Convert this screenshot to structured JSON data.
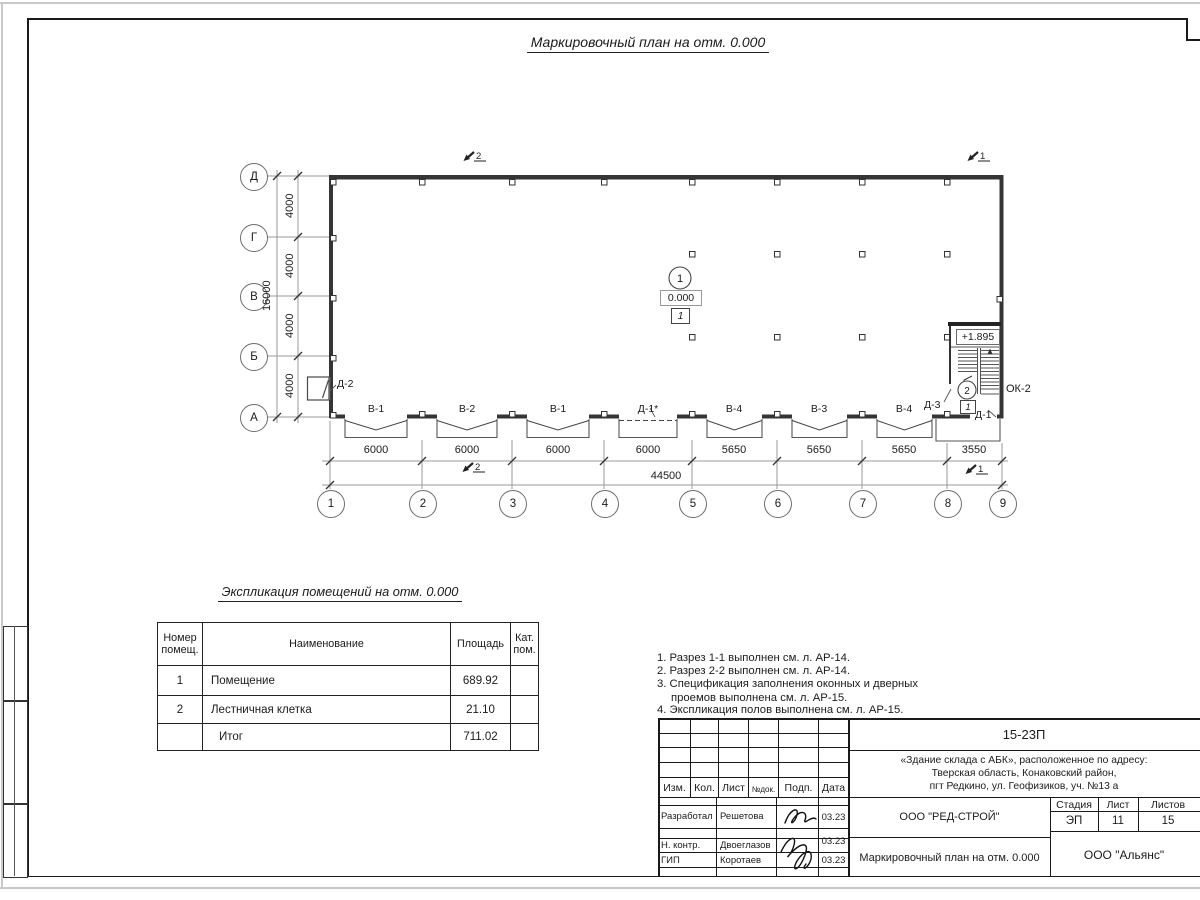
{
  "page": {
    "title": "Маркировочный план на отм. 0.000"
  },
  "plan": {
    "sec1": "1",
    "sec2": "2",
    "row_axes": [
      "Д",
      "Г",
      "В",
      "Б",
      "А"
    ],
    "col_axes": [
      "1",
      "2",
      "3",
      "4",
      "5",
      "6",
      "7",
      "8",
      "9"
    ],
    "v_dims": [
      "4000",
      "4000",
      "4000",
      "4000"
    ],
    "v_total": "16000",
    "h_dims": [
      "6000",
      "6000",
      "6000",
      "6000",
      "5650",
      "5650",
      "5650",
      "3550"
    ],
    "h_total": "44500",
    "openings": [
      "В-1",
      "В-2",
      "В-1",
      "Д-1*",
      "В-4",
      "В-3",
      "В-4"
    ],
    "door_d2": "Д-2",
    "door_d3": "Д-3",
    "door_d1": "Д-1",
    "window_ok2": "ОК-2",
    "room1": {
      "number": "1",
      "elevation": "0.000",
      "floor_tag": "1"
    },
    "room2": {
      "number": "2",
      "elevation": "+1.895",
      "floor_tag": "1"
    }
  },
  "explication": {
    "title": "Экспликация помещений на отм. 0.000",
    "headers": [
      "Номер помещ.",
      "Наименование",
      "Площадь",
      "Кат. пом."
    ],
    "rows": [
      {
        "num": "1",
        "name": "Помещение",
        "area": "689.92",
        "cat": ""
      },
      {
        "num": "2",
        "name": "Лестничная клетка",
        "area": "21.10",
        "cat": ""
      },
      {
        "num": "",
        "name": "Итог",
        "area": "711.02",
        "cat": ""
      }
    ]
  },
  "notes": [
    "1. Разрез 1-1 выполнен см. л. АР-14.",
    "2. Разрез 2-2 выполнен см. л. АР-14.",
    "3. Спецификация заполнения оконных и дверных проемов выполнена см. л. АР-15.",
    "4. Экспликация полов выполнена см. л. АР-15."
  ],
  "titleblock": {
    "doc_number": "15-23П",
    "address_line1": "«Здание склада с АБК», расположенное по адресу:",
    "address_line2": "Тверская область, Конаковский район,",
    "address_line3": "пгт Редкино, ул. Геофизиков, уч. №13 а",
    "col_izm": "Изм.",
    "col_kol": "Кол.",
    "col_list": "Лист",
    "col_ndok": "№док.",
    "col_podp": "Подп.",
    "col_data": "Дата",
    "roles": [
      {
        "role": "Разработал",
        "name": "Решетова",
        "date": "03.23"
      },
      {
        "role": "Н. контр.",
        "name": "Двоеглазов",
        "date": "03.23"
      },
      {
        "role": "ГИП",
        "name": "Коротаев",
        "date": "03.23"
      }
    ],
    "org_design": "ООО \"РЕД-СТРОЙ\"",
    "drawing_title": "Маркировочный план на отм. 0.000",
    "stage_label": "Стадия",
    "sheet_label": "Лист",
    "sheets_label": "Листов",
    "stage": "ЭП",
    "sheet": "11",
    "sheets": "15",
    "org_customer": "ООО \"Альянс\""
  }
}
